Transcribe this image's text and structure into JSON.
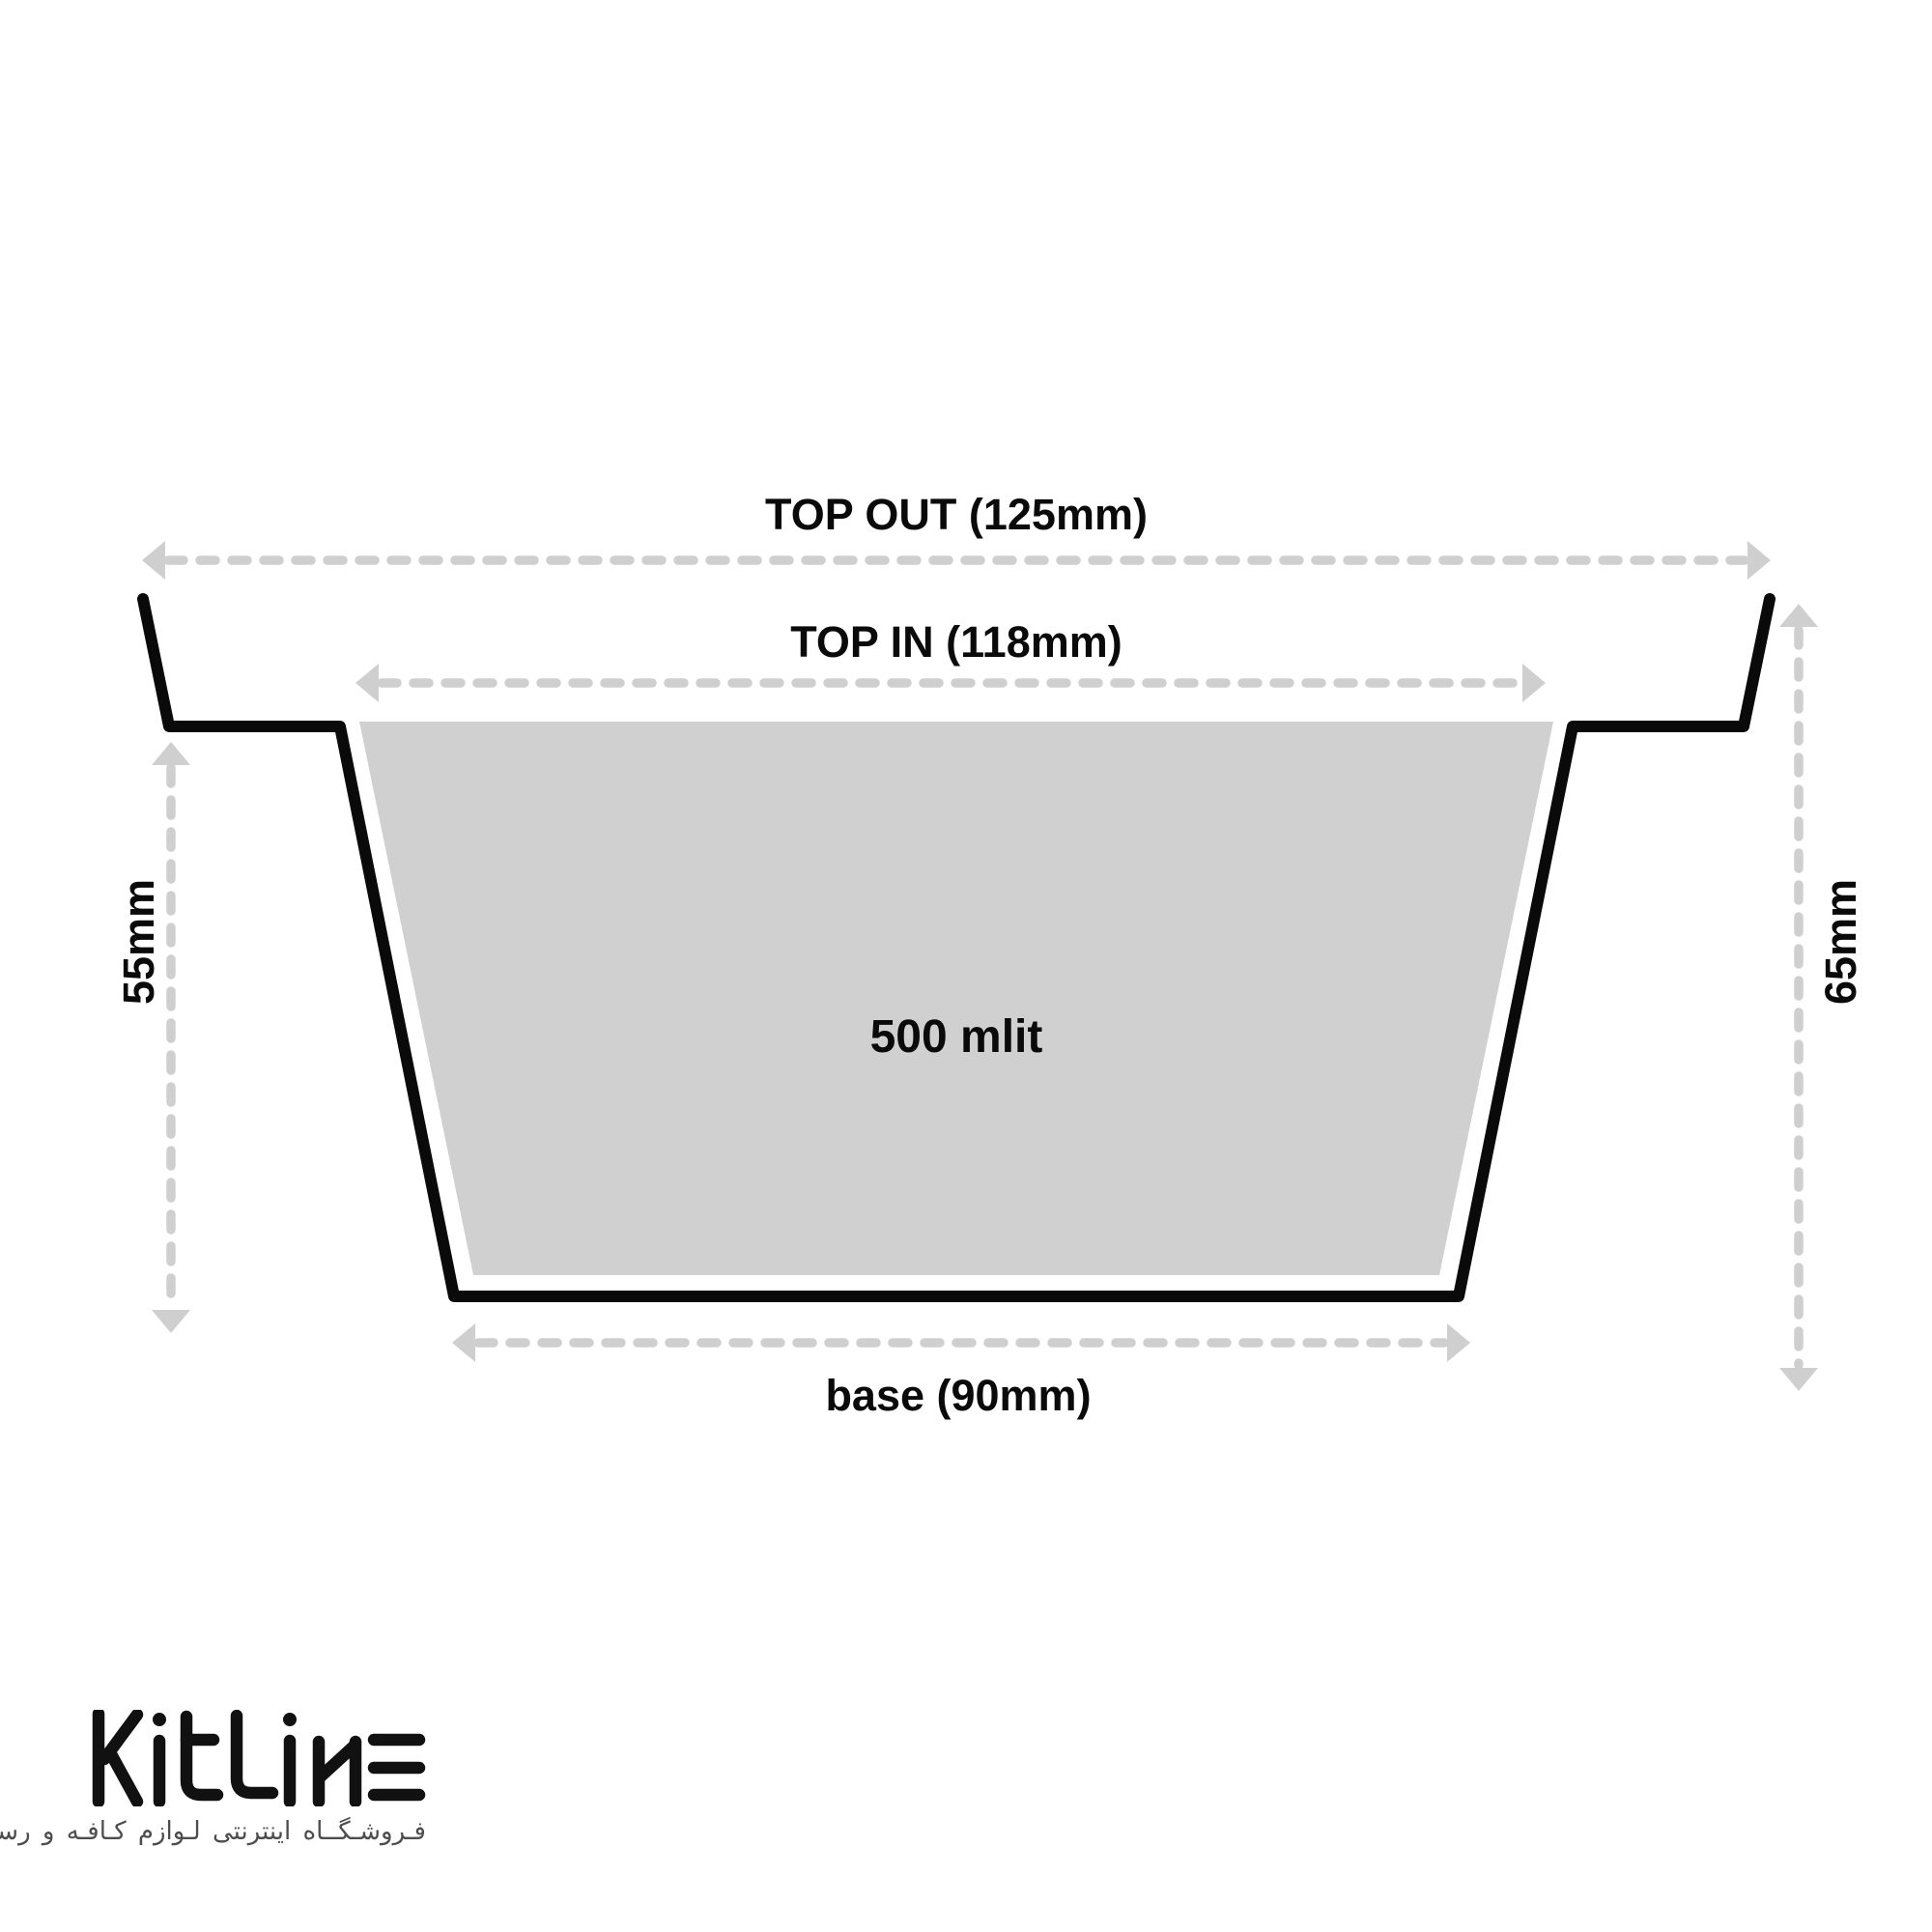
{
  "page": {
    "background": "#ffffff"
  },
  "diagram": {
    "volume_label": "500 mlit",
    "dimensions": {
      "top_out_label": "TOP OUT (125mm)",
      "top_in_label": "TOP IN (118mm)",
      "base_label": "base (90mm)",
      "left_height_label": "55mm",
      "right_height_label": "65mm"
    },
    "colors": {
      "outline": "#0a0a0a",
      "inner_fill": "#d0d0d0",
      "dimension_gray": "#cfcfcf",
      "label_text": "#0a0a0a"
    }
  },
  "branding": {
    "logo_text": "KitLine",
    "logo_color": "#111111",
    "tagline": "فـروشـگــاه اینترنتی لـوازم کـافـه و رستـوران",
    "tagline_color": "#4d4d4d"
  }
}
